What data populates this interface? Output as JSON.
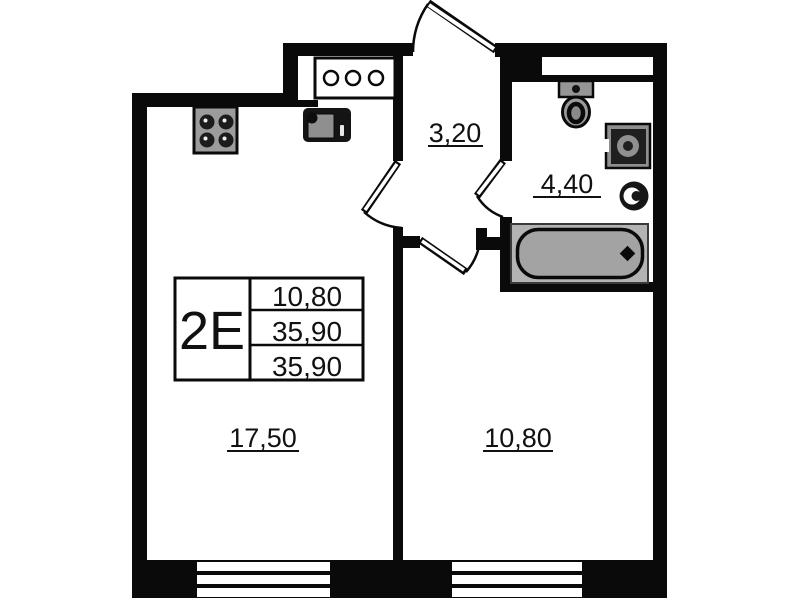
{
  "unit": {
    "type_label": "2E",
    "table_rows": [
      "10,80",
      "35,90",
      "35,90"
    ]
  },
  "rooms": {
    "living_kitchen": {
      "area": "17,50"
    },
    "bedroom": {
      "area": "10,80"
    },
    "hall": {
      "area": "3,20"
    },
    "bathroom": {
      "area": "4,40"
    }
  },
  "fixtures": [
    "stove-4-burner-icon",
    "kitchen-sink-icon",
    "utility-risers-icon",
    "toilet-icon",
    "washing-machine-icon",
    "wash-basin-icon",
    "bathtub-icon",
    "entrance-door",
    "living-room-door",
    "bedroom-door",
    "bathroom-door",
    "window-living",
    "window-bedroom"
  ],
  "colors": {
    "wall": "#0a0a0a",
    "background": "#ffffff",
    "fixture_gray": "#9c9c9c",
    "text": "#111111"
  }
}
